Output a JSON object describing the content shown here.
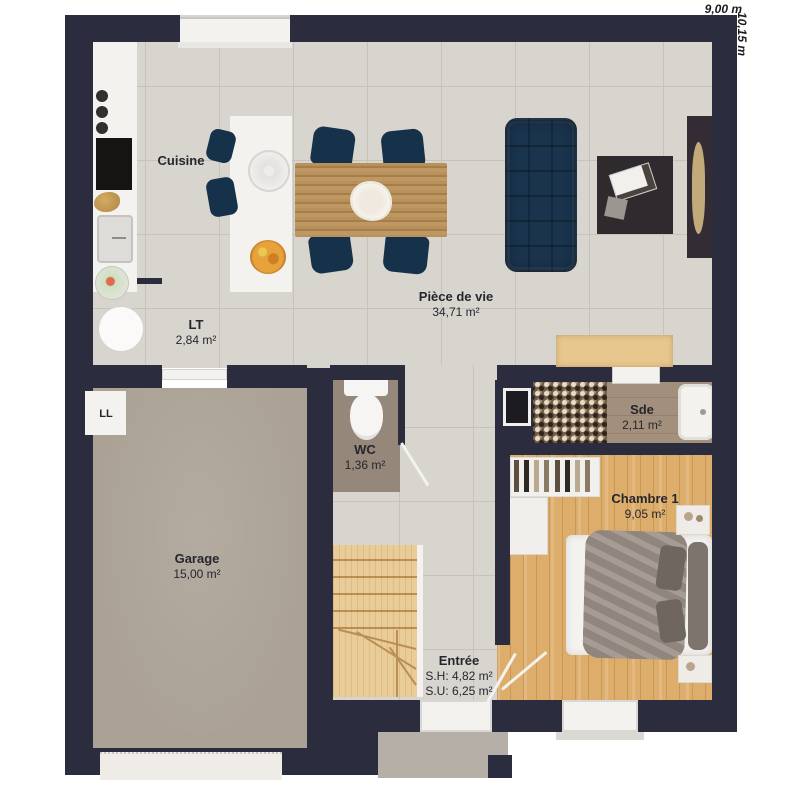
{
  "dimensions": {
    "width": "9,00 m",
    "height": "10,15 m"
  },
  "rooms": [
    {
      "id": "cuisine",
      "name": "Cuisine",
      "area": ""
    },
    {
      "id": "piece-de-vie",
      "name": "Pièce de vie",
      "area": "34,71 m²"
    },
    {
      "id": "lt",
      "name": "LT",
      "area": "2,84 m²"
    },
    {
      "id": "wc",
      "name": "WC",
      "area": "1,36 m²"
    },
    {
      "id": "sde",
      "name": "Sde",
      "area": "2,11 m²"
    },
    {
      "id": "chambre-1",
      "name": "Chambre 1",
      "area": "9,05 m²"
    },
    {
      "id": "garage",
      "name": "Garage",
      "area": "15,00 m²"
    },
    {
      "id": "entree",
      "name": "Entrée",
      "area_sh": "S.H: 4,82 m²",
      "area_su": "S.U: 6,25 m²"
    }
  ],
  "fixtures": {
    "washing_machine": "LL"
  },
  "colors": {
    "wall": "#2b2d3e",
    "tile": "#d8d4ce",
    "tile_line": "#c6c2bc",
    "garage_floor": "#aba295",
    "wc_floor": "#95887a",
    "sde_floor": "#a2907c",
    "porch": "#b6afa7",
    "wood_floor": "#ddae6b",
    "stair_wood": "#e9cc97",
    "sofa_navy": "#1a344e",
    "chair_navy": "#16314a",
    "table_wood": "#b28c58",
    "dark_furniture": "#2e2a2e",
    "white_fixture": "#f4f2ef",
    "sideboard_tan": "#e8c78f",
    "tv_tan": "#c3aa7b",
    "duvet_gray": "#9c9189",
    "label_text": "#26262e"
  }
}
